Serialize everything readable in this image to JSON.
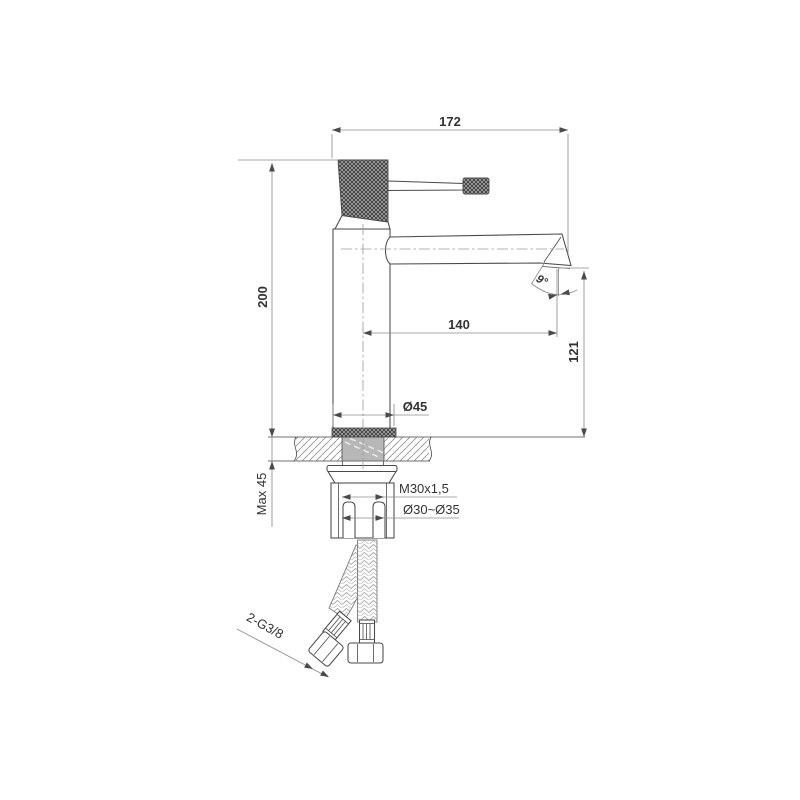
{
  "drawing": {
    "type": "faucet-installation-dimension-drawing",
    "labels": {
      "overall_width": "172",
      "overall_height": "200",
      "spout_reach": "140",
      "outlet_height": "121",
      "base_diameter": "Ø45",
      "spout_angle": "9°",
      "max_deck_thickness": "Max 45",
      "shank_thread": "M30x1,5",
      "hole_diameter_range": "Ø30~Ø35",
      "hose_connections": "2-G3/8"
    }
  },
  "colors": {
    "background": "#ffffff",
    "outline": "#4a4a4a",
    "dimension": "#8e8e8e",
    "text": "#333333",
    "arrow": "#4a4a4a",
    "shank_fill": "#b7b7b7"
  }
}
